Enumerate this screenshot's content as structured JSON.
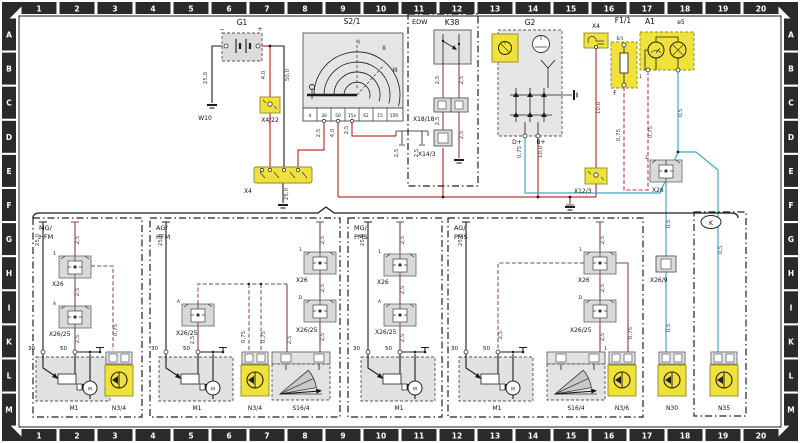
{
  "grid": {
    "columns": [
      "1",
      "2",
      "3",
      "4",
      "5",
      "6",
      "7",
      "8",
      "9",
      "10",
      "11",
      "12",
      "13",
      "14",
      "15",
      "16",
      "17",
      "18",
      "19",
      "20"
    ],
    "rows": [
      "A",
      "B",
      "C",
      "D",
      "E",
      "F",
      "G",
      "H",
      "I",
      "K",
      "L",
      "M"
    ]
  },
  "colors": {
    "tab_bg": "#2a2a2a",
    "tab_text": "#ffffff",
    "highlight_yellow": "#f1e23b",
    "component_gray": "#dcdcdc",
    "wire_red": "#bf3434",
    "wire_maroon": "#8a3c58",
    "wire_blue": "#3fa9c4",
    "wire_black": "#1c1c1c"
  },
  "top": {
    "g1": {
      "label": "G1",
      "minus": "−",
      "plus": "+"
    },
    "w10": {
      "label": "W10"
    },
    "x4_22": {
      "label": "X4/22"
    },
    "x4bus": {
      "label": "X4"
    },
    "s2_1": {
      "label": "S2/1",
      "pos_i": "I",
      "pos_ii": "II",
      "pos_iii": "III",
      "pins": [
        "4",
        "30",
        "50",
        "15x",
        "62",
        "15",
        "15R"
      ]
    },
    "edw": {
      "label": "EDW",
      "relay": "K38",
      "x18_18": "X18/18",
      "x14_3": "X14/3"
    },
    "g2": {
      "label": "G2",
      "dplus": "D+",
      "bplus": "B+"
    },
    "x4top": {
      "label": "X4"
    },
    "x12_3": {
      "label": "X12/3"
    },
    "f1_1": {
      "label": "F1/1",
      "pin_top": "6/1",
      "pin_bottom": "F"
    },
    "a1": {
      "label": "A1",
      "sub": "e5",
      "pin": "1"
    }
  },
  "right": {
    "x26": {
      "label": "X26",
      "pin": "1"
    },
    "x26_9": {
      "label": "X26/9"
    },
    "n30": {
      "label": "N30"
    },
    "n35": {
      "label": "N35"
    },
    "k_badge": "K"
  },
  "sym": {
    "motor": "M"
  },
  "sections": [
    {
      "title1": "MG/",
      "title2": "HFM",
      "x26": "X26",
      "x26_pin": "1",
      "x2625": "X26/25",
      "x2625_pin": "A",
      "t30": "30",
      "t50": "50",
      "m1": "M1",
      "n3": "N3/4"
    },
    {
      "title1": "AG/",
      "title2": "HFM",
      "x26": "X26",
      "x26_pin": "1",
      "x2625a": "X26/25",
      "x2625a_pin": "A",
      "x2625d": "X26/25",
      "x2625d_pin": "D",
      "t30": "30",
      "t50": "50",
      "m1": "M1",
      "n3": "N3/4",
      "s16": "S16/4"
    },
    {
      "title1": "MG/",
      "title2": "PMS",
      "x26": "X26",
      "x26_pin": "1",
      "x2625": "X26/25",
      "x2625_pin": "A",
      "t30": "30",
      "t50": "50",
      "m1": "M1"
    },
    {
      "title1": "AG/",
      "title2": "PMS",
      "x26": "X26",
      "x26_pin": "1",
      "x2625": "X26/25",
      "x2625_pin": "D",
      "t30": "30",
      "t50": "50",
      "m1": "M1",
      "n3": "N3/6",
      "n3_pin": "1",
      "s16": "S16/4"
    }
  ],
  "wire_labels": [
    {
      "t": "25,0",
      "x": 207,
      "y": 78
    },
    {
      "t": "4,0",
      "x": 265,
      "y": 75
    },
    {
      "t": "50,0",
      "x": 289,
      "y": 75
    },
    {
      "t": "2,5",
      "x": 320,
      "y": 133
    },
    {
      "t": "4,0",
      "x": 334,
      "y": 133
    },
    {
      "t": "2,5",
      "x": 348,
      "y": 130
    },
    {
      "t": "2,5",
      "x": 398,
      "y": 153
    },
    {
      "t": "2,5",
      "x": 418,
      "y": 153
    },
    {
      "t": "2,5",
      "x": 439,
      "y": 80
    },
    {
      "t": "2,5",
      "x": 463,
      "y": 80
    },
    {
      "t": "2,5",
      "x": 439,
      "y": 121
    },
    {
      "t": "2,5",
      "x": 463,
      "y": 135
    },
    {
      "t": "25,0",
      "x": 288,
      "y": 194
    },
    {
      "t": "0,75",
      "x": 521,
      "y": 152
    },
    {
      "t": "10,0",
      "x": 542,
      "y": 152
    },
    {
      "t": "10,0",
      "x": 600,
      "y": 108
    },
    {
      "t": "0,75",
      "x": 620,
      "y": 135
    },
    {
      "t": "0,75",
      "x": 652,
      "y": 132
    },
    {
      "t": "0,5",
      "x": 682,
      "y": 113
    },
    {
      "t": "0,5",
      "x": 670,
      "y": 224
    },
    {
      "t": "0,5",
      "x": 670,
      "y": 328
    },
    {
      "t": "0,5",
      "x": 722,
      "y": 250
    },
    {
      "t": "25,0",
      "x": 39,
      "y": 240
    },
    {
      "t": "2,5",
      "x": 79,
      "y": 240
    },
    {
      "t": "2,5",
      "x": 79,
      "y": 292
    },
    {
      "t": "2,5",
      "x": 79,
      "y": 339
    },
    {
      "t": "0,75",
      "x": 117,
      "y": 330
    },
    {
      "t": "25,0",
      "x": 162,
      "y": 240
    },
    {
      "t": "2,5",
      "x": 324,
      "y": 240
    },
    {
      "t": "2,5",
      "x": 324,
      "y": 288
    },
    {
      "t": "2,5",
      "x": 324,
      "y": 337
    },
    {
      "t": "2,5",
      "x": 291,
      "y": 340
    },
    {
      "t": "2,5",
      "x": 194,
      "y": 340
    },
    {
      "t": "0,75",
      "x": 245,
      "y": 337
    },
    {
      "t": "0,75",
      "x": 265,
      "y": 337
    },
    {
      "t": "25,0",
      "x": 364,
      "y": 240
    },
    {
      "t": "2,5",
      "x": 404,
      "y": 240
    },
    {
      "t": "2,5",
      "x": 404,
      "y": 290
    },
    {
      "t": "2,5",
      "x": 404,
      "y": 338
    },
    {
      "t": "25,0",
      "x": 462,
      "y": 240
    },
    {
      "t": "2,5",
      "x": 604,
      "y": 240
    },
    {
      "t": "2,5",
      "x": 604,
      "y": 288
    },
    {
      "t": "2,5",
      "x": 604,
      "y": 337
    },
    {
      "t": "2,5",
      "x": 502,
      "y": 335
    },
    {
      "t": "0,75",
      "x": 632,
      "y": 333
    }
  ]
}
